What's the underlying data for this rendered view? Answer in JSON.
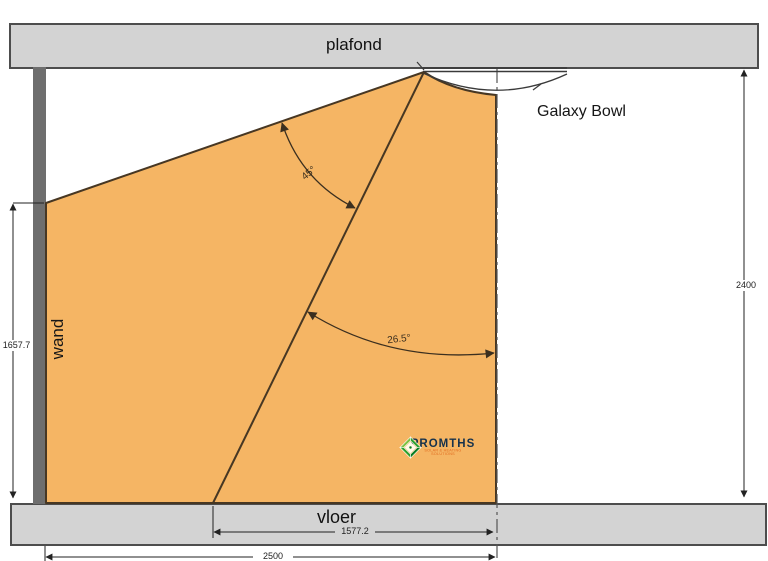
{
  "labels": {
    "ceiling": "plafond",
    "wall": "wand",
    "floor": "vloer",
    "fixture": "Galaxy Bowl",
    "angle_beam_spread": "45°",
    "angle_beam_tilt": "26.5°"
  },
  "dimensions": {
    "wall_height": "1657.7",
    "room_height": "2400",
    "beam_floor_offset": "1577.2",
    "total_width": "2500"
  },
  "logo": {
    "brand": "PROMTHS",
    "tagline": "SOLAR & HEATING SOLUTIONS"
  },
  "colors": {
    "beam_fill": "#F5B564",
    "surface_gray": "#D3D3D3",
    "wall_gray": "#6E6E6E",
    "outline_dark": "#473723",
    "dimension_line": "#222222",
    "logo_green_dark": "#0C7C22",
    "logo_green_mid": "#2DA02D",
    "logo_green_light": "#7CC142",
    "logo_text": "#16324C",
    "logo_tagline": "#E06A1E"
  }
}
